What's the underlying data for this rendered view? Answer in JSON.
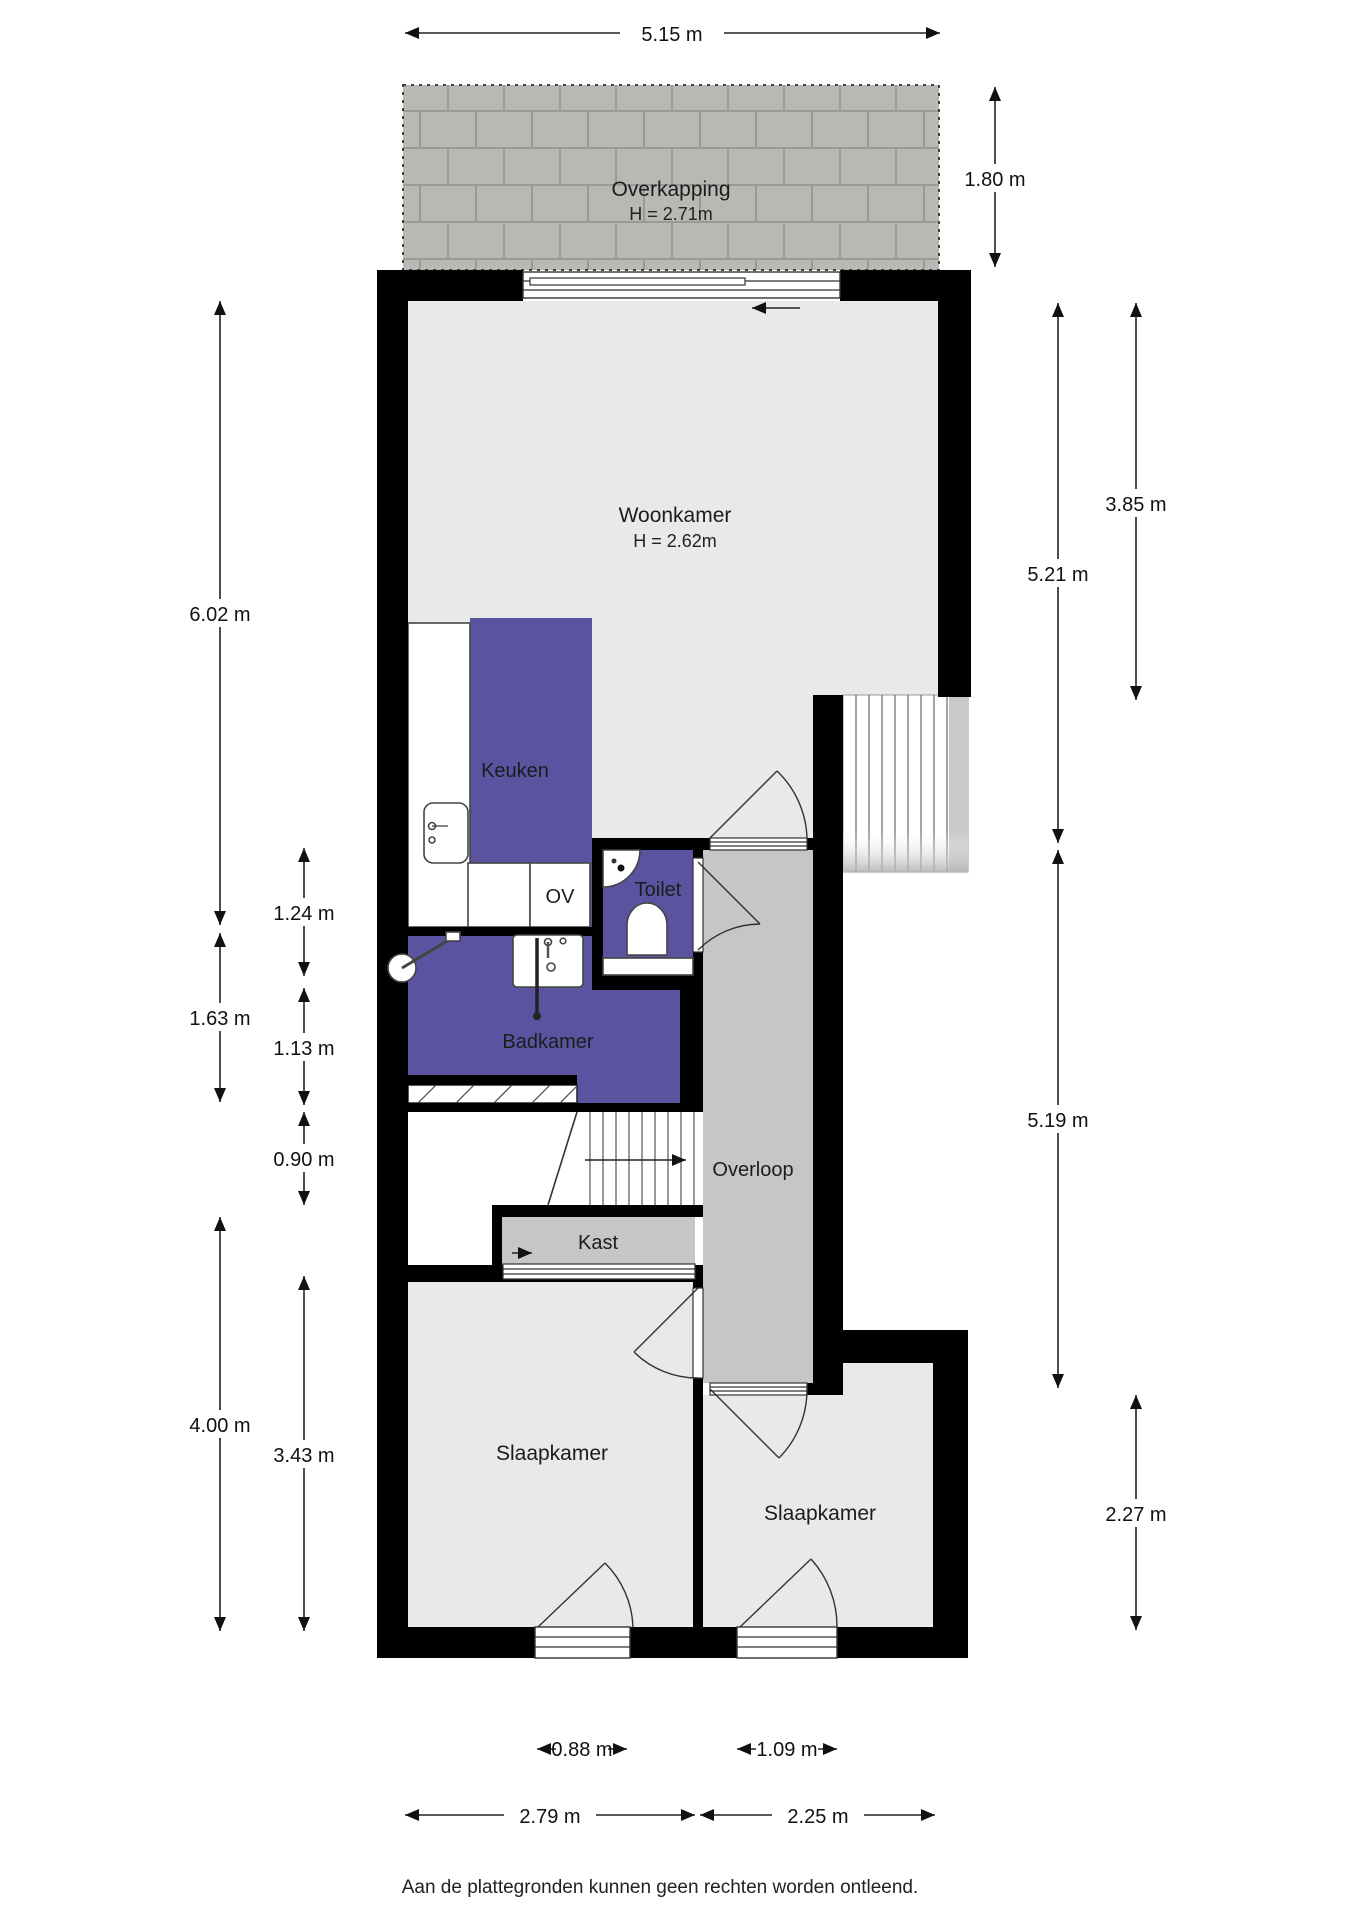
{
  "rooms": {
    "overkapping": {
      "label": "Overkapping",
      "height": "H = 2.71m"
    },
    "woonkamer": {
      "label": "Woonkamer",
      "height": "H = 2.62m"
    },
    "keuken": {
      "label": "Keuken"
    },
    "ov": {
      "label": "OV"
    },
    "toilet": {
      "label": "Toilet"
    },
    "badkamer": {
      "label": "Badkamer"
    },
    "overloop": {
      "label": "Overloop"
    },
    "kast": {
      "label": "Kast"
    },
    "slaapkamer_left": {
      "label": "Slaapkamer"
    },
    "slaapkamer_right": {
      "label": "Slaapkamer"
    }
  },
  "dimensions": {
    "top": "5.15 m",
    "overkapping_depth": "1.80 m",
    "right_upper_outer": "3.85 m",
    "right_upper": "5.21 m",
    "right_lower": "5.19 m",
    "right_bedroom": "2.27 m",
    "left_main": "6.02 m",
    "toilet_strip": "1.24 m",
    "badkamer_outer": "1.63 m",
    "badkamer_inner": "1.13 m",
    "stairs": "0.90 m",
    "left_lower": "4.00 m",
    "bedroom_left_height": "3.43 m",
    "window_left": "0.88 m",
    "window_right": "1.09 m",
    "bedroom_left_width": "2.79 m",
    "bedroom_right_width": "2.25 m"
  },
  "footer": {
    "disclaimer": "Aan de plattegronden kunnen geen rechten worden ontleend."
  },
  "colors": {
    "wall": "#000000",
    "floor": "#e9e9e9",
    "hall": "#c6c6c6",
    "purple": "#5a54a0",
    "paver": "#b8b8b5",
    "paver_joint": "#9a9a97",
    "stair_shade": "#c9c9c9"
  }
}
